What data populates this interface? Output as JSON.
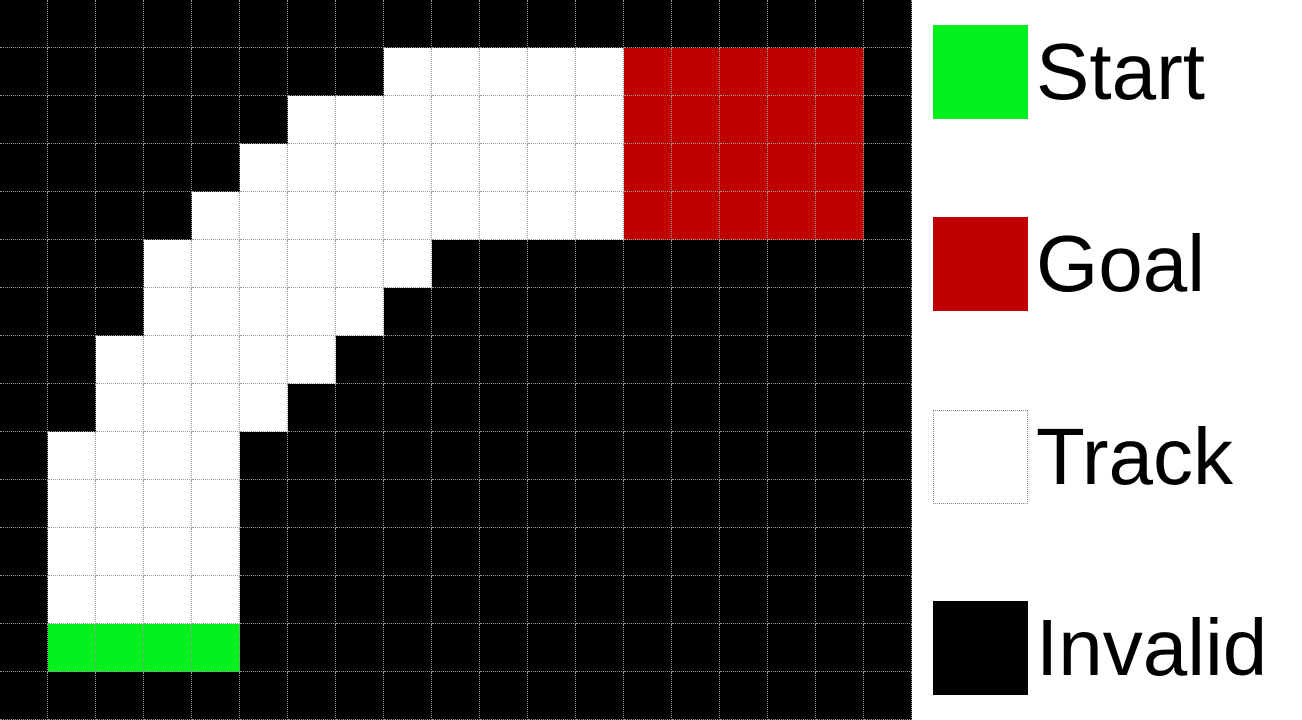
{
  "figure": {
    "name": "racetrack-gridworld",
    "columns": 19,
    "rows": 15,
    "cell_size_px": 48
  },
  "grid": {
    "gridline_color": "#999999",
    "palette": {
      "K": "#000000",
      "W": "#ffffff",
      "S": "#00f01e",
      "G": "#c00000"
    },
    "rows": [
      "KKKKKKKKKKKKKKKKKKK",
      "KKKKKKKKWWWWWGGGGGK",
      "KKKKKKWWWWWWWGGGGGK",
      "KKKKKWWWWWWWWGGGGGK",
      "KKKKWWWWWWWWWGGGGGK",
      "KKKWWWWWWKKKKKKKKKK",
      "KKKWWWWWKKKKKKKKKKK",
      "KKWWWWWKKKKKKKKKKKK",
      "KKWWWWKKKKKKKKKKKKK",
      "KWWWWKKKKKKKKKKKKKK",
      "KWWWWKKKKKKKKKKKKKK",
      "KWWWWKKKKKKKKKKKKKK",
      "KWWWWKKKKKKKKKKKKKK",
      "KSSSSKKKKKKKKKKKKKK",
      "KKKKKKKKKKKKKKKKKKK"
    ]
  },
  "legend": {
    "background": "#ffffff",
    "items": [
      {
        "label": "Start",
        "swatch_color": "#00f01e",
        "swatch_style": "solid"
      },
      {
        "label": "Goal",
        "swatch_color": "#c00000",
        "swatch_style": "solid"
      },
      {
        "label": "Track",
        "swatch_color": "#ffffff",
        "swatch_style": "dotted-border"
      },
      {
        "label": "Invalid",
        "swatch_color": "#000000",
        "swatch_style": "solid"
      }
    ]
  }
}
